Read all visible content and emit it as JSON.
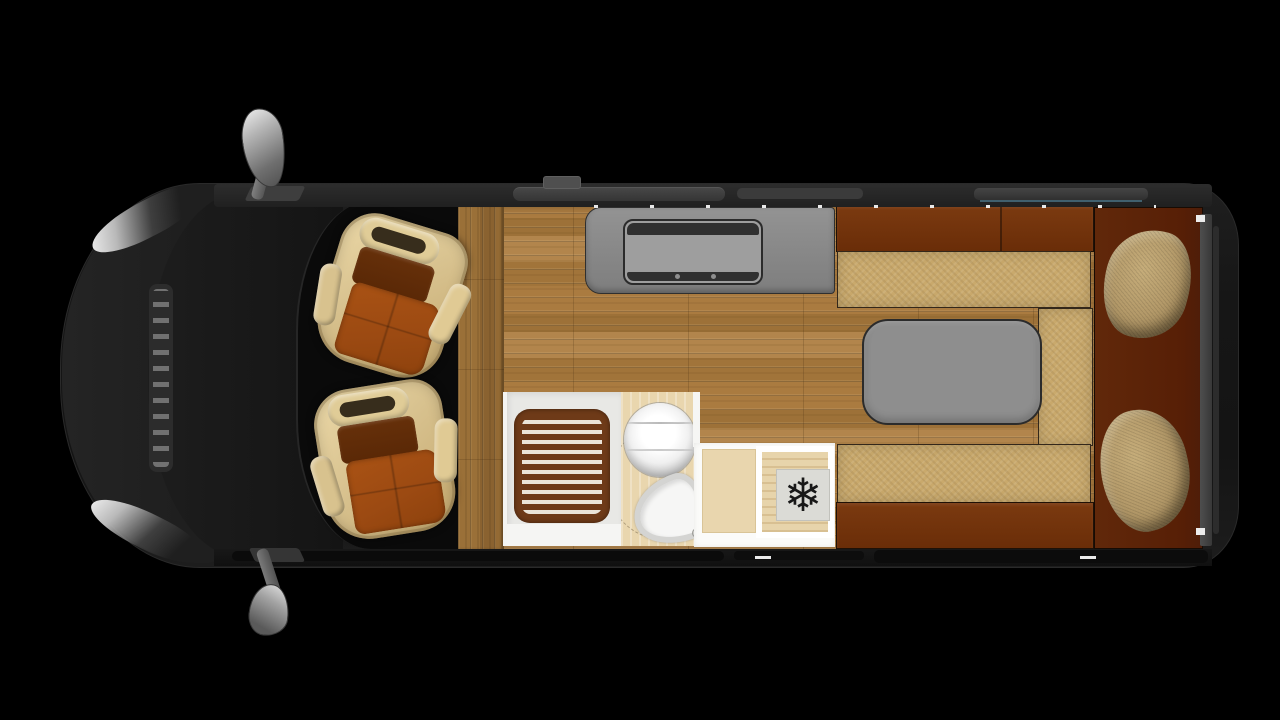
{
  "icons": {
    "snowflake": "❄"
  },
  "colors": {
    "canvas-bg": "#000000",
    "van-body": "#1a1a1a",
    "wood": "#a87c42",
    "wood-dark": "#8a6230",
    "counter-gray": "#8d8d8d",
    "cooktop-gray": "#9e9e9e",
    "trim-dark": "#303030",
    "furniture-brown": "#72330b",
    "bed-brown": "#571f06",
    "cushion-tan": "#c9a96c",
    "pillow-tan": "#b19767",
    "table-gray": "#8e8e8e",
    "shower-tray": "#e8e8e5",
    "mat-brown": "#6e3a18",
    "mat-slat": "#ebe4d8",
    "bath-floor": "#e9d6ae",
    "porcelain": "#f6f6f5",
    "fridge-plate": "#dbdbd6",
    "icon-dark": "#181818",
    "seat-frame": "#d8c28f",
    "seat-cushion": "#9c4a12",
    "seat-back": "#66300a",
    "mirror-gray": "#9e9e9e",
    "accent-teal": "#41606e"
  },
  "areas": {
    "cab": "driver-cab",
    "driver_seat": "swivel-seat",
    "passenger_seat": "swivel-seat",
    "kitchen": "kitchen-counter-with-cooktop",
    "bathroom": "shower-toilet-washbasin",
    "fridge": "fridge-with-snowflake",
    "dinette": "bench-seating-with-table",
    "rear_bed": "bed-with-two-pillows"
  }
}
